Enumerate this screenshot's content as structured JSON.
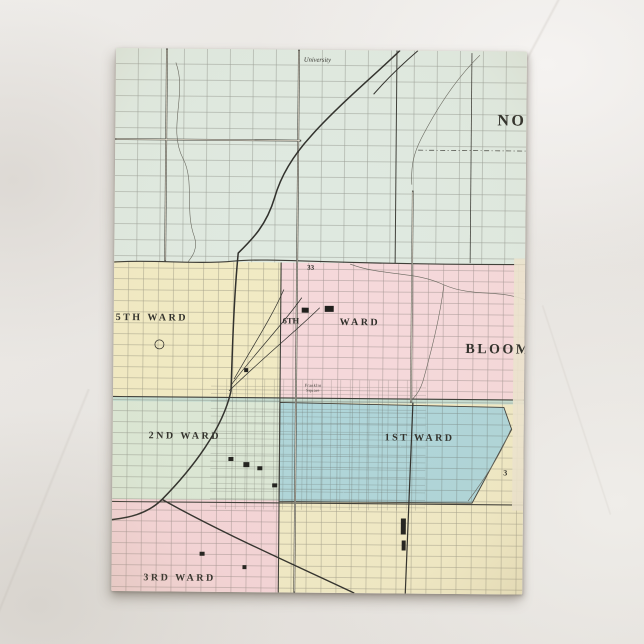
{
  "scene": {
    "surface": "marble-countertop"
  },
  "postcard": {
    "description": "vintage ward map of Bloomington and Normal",
    "map": {
      "labels": {
        "university": "University",
        "normal": "NO",
        "bloomington": "BLOOM",
        "ward5": "5TH WARD",
        "ward6_num": "6TH",
        "ward6_word": "WARD",
        "ward2": "2ND WARD",
        "ward1": "1ST WARD",
        "ward3": "3RD WARD",
        "block33": "33",
        "section3": "3",
        "franklin1": "Franklin",
        "franklin2": "Square"
      },
      "colors": {
        "mint": "#dfe9e0",
        "yellow": "#f1eac3",
        "pink": "#f5d8da",
        "green": "#dbe7d5",
        "teal": "#c6ddd1",
        "blue": "#aed5d9",
        "yellow_se": "#f0e9c5",
        "pink_sw": "#f4d4d7",
        "cream_edge": "#ece4cf",
        "ink": "#3f3f39",
        "rail": "#2e2e2a",
        "creek": "#63635a"
      }
    }
  }
}
